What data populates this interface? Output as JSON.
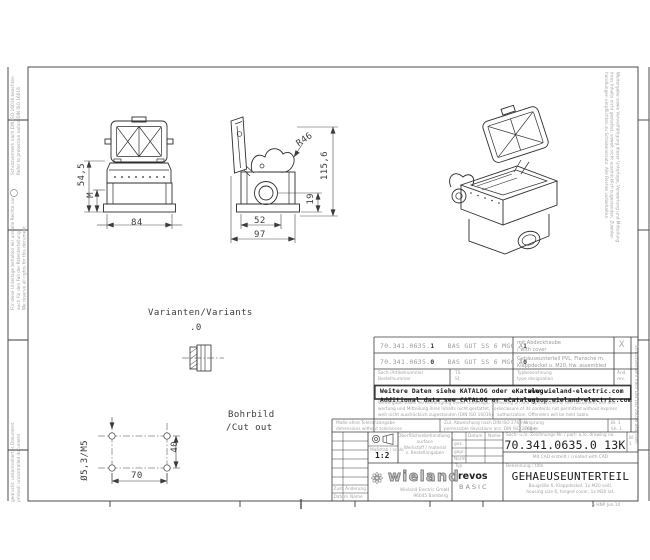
{
  "drawing": {
    "front": {
      "dim_h": "54,5",
      "dim_m": "M",
      "dim_w": "84"
    },
    "side": {
      "dim_r": "R46",
      "dim_h": "115,6",
      "dim_off": "19",
      "dim_w1": "52",
      "dim_w2": "97"
    },
    "variants": {
      "label": "Varianten/Variants",
      "value": ".0"
    },
    "cutout": {
      "title": "Bohrbild",
      "title2": "/Cut out",
      "dim_w": "70",
      "dim_h": "40",
      "dim_hole": "Ø5,3/M5"
    }
  },
  "table": {
    "rows": [
      {
        "no": "70.341.0635.",
        "no_var": "1",
        "type": "BAS GUT SS 6 MGC A",
        "type_var": "1",
        "desc1": "mit Abdeckhaube",
        "desc2": "/ with cover",
        "flag": "X"
      },
      {
        "no": "70.341.0635.",
        "no_var": "0",
        "type": "BAS GUT SS 6 MGC A",
        "type_var": "0",
        "desc1": "Gehäuseunterteil PVL, Flansche m.",
        "desc2": "Klappdeckel u. M20, tlw. assembled",
        "flag": ""
      }
    ],
    "header": {
      "col1a": "Sach-/Artikelnummer",
      "col1b": "Bestellnummer",
      "col2a": "TS",
      "col2b": "St.",
      "col3a": "Typbezeichnung",
      "col3b": "type designation",
      "col4a": "Änd.",
      "col4b": "rev."
    },
    "catalog": {
      "line_de": "Weitere Daten siehe KATALOG oder eKatalog.",
      "line_en": "Additional data see CATALOG or eCatalog.",
      "url1": "www.wieland-electric.com",
      "url2": "eshop.wieland-electric.com"
    },
    "legal": {
      "de": [
        "Weitergabe sowie Vervielfältigung dieser Unterlage, Ver-",
        "wertung und Mitteilung ihres Inhalts nicht gestattet, so-",
        "weit nicht ausdrücklich zugestanden (DIN ISO 16016)."
      ],
      "en": [
        "Passing on and reproduction of this document, use and",
        "disclosure of its contents not permitted without express",
        "authorization. Offenders will be held liable."
      ]
    },
    "units": {
      "c1a": "Maße ohne Toleranzangabe",
      "c1b": "dimensions without tolerances",
      "c2a": "Zul. Abweichung nach DIN ISO 2768-m",
      "c2b": "permissible deviations acc. DIN ISO 2768-m",
      "c3a": "Ursprung",
      "c3b": "origin",
      "c4a": "Bl. 1",
      "c4b": "Sh. 1"
    }
  },
  "titleblock": {
    "scale_label": "Maßstab / scale",
    "scale": "1:2",
    "material": [
      "Oberflächenbehandlung /",
      "surface",
      "Werkstoff / material",
      "s. Bestellangaben"
    ],
    "grid": {
      "h1": "Datum",
      "h2": "Name",
      "r1": "gez.",
      "r2": "gepr.",
      "r3": "Norm"
    },
    "docno_label": "Sach- u./o. Zeichnungs-Nr. / part- a./o. drawing no.",
    "docno": "70.341.0635.0 13K",
    "sheet_a": "Bl.",
    "sheet_b": "1",
    "subline": "Mit CAD erstellt / created with CAD",
    "brand": "wieland",
    "brand_sub1": "Wieland Electric GmbH",
    "brand_sub2": "96045 Bamberg",
    "type_label": "Typ",
    "series1": "revos",
    "series2": "BASIC",
    "title_label": "Benennung / title",
    "title": "GEHAEUSEUNTERTEIL",
    "title_sub1": "Baugröße 6, Klappdeckel, 1x M20 seitl.",
    "title_sub2": "housing size 6, hinged cover, 1x M20 lat.",
    "rev_r1a": "Zust.",
    "rev_r1b": "Änderung",
    "rev_r2a": "Datum",
    "rev_r2b": "Name",
    "corner_note": "A  HNP Jun.10"
  },
  "margins": {
    "left_a": [
      "Schutzvermerk nach DIN ISO 16016 beachten",
      "Refer to protection notice DIN ISO 16016"
    ],
    "left_b": [
      "Für diese Unterlage behalten wir uns alle Rechte vor,",
      "auch für den Fall der Patenterteilung",
      "We reserve all rights for this document"
    ],
    "left_c": [
      "gedruckt: unkontrolliertes Dokument",
      "printed: uncontrolled document"
    ],
    "right_block": [
      "Weitergabe sowie Vervielfältigung dieser Unterlage, Verwertung und Mitteilung",
      "ihres Inhalts nicht gestattet, soweit nicht ausdrücklich zugestanden. Zuwider-",
      "handlungen verpflichten zu Schadenersatz. Alle Rechte vorbehalten."
    ],
    "right_strip": "Schutzvermerk nach DIN ISO 16016 beachten"
  }
}
